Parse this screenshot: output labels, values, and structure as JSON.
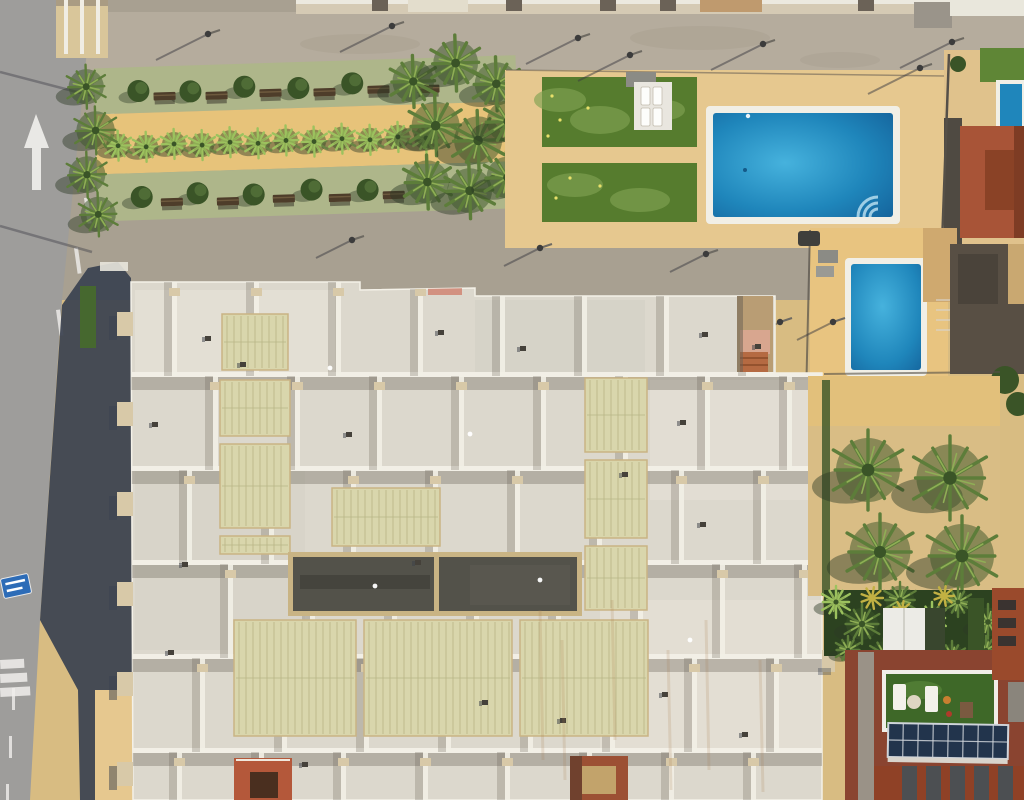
{
  "scene": {
    "description": "Top-down aerial drone photograph of a Mediterranean apartment complex: white terraced roof with skylights and a dark central lightwell, communal swimming pool with lawn and sun loungers, a second smaller pool, palm-lined garden promenade along a grey road with a white arrow marking, palm courtyard, and a neighbouring terracotta building with rooftop terrace and solar panels",
    "view": "orthogonal top-down",
    "lighting": "sunny, shadows cast to lower-left"
  },
  "palette": {
    "road": "#9e9d9b",
    "road_mark": "#f0efec",
    "promenade": "#b5ac9d",
    "walkway": "#a8a091",
    "stain": "#857d6f",
    "sand": "#d8bc82",
    "deck": "#e6c88f",
    "deck_bright": "#e8c480",
    "garden_green": "#aeb68a",
    "garden_orange": "#e7c37a",
    "tree_dark": "#3a5427",
    "tree_mid": "#5d7d3a",
    "tree_light": "#8fae55",
    "palm_bright": "#9cc25e",
    "palm_yellow": "#c2b143",
    "planter": "#d2b584",
    "bench": "#4e3d2a",
    "lawn": "#567c2e",
    "lawn_light": "#7fa251",
    "flower": "#e8e06a",
    "pool_rim": "#f1efe6",
    "pool_light": "#46b2dd",
    "pool_mid": "#1f86bb",
    "pool_deep": "#135e97",
    "pool_step": "#bfe4f2",
    "roof_base": "#dcd8cd",
    "roof_light": "#eae6db",
    "roof_dim": "#d2cfc4",
    "parapet": "#f2efe6",
    "parapet_tan": "#d8c9a8",
    "roof_shadow": "#5f594d",
    "skylight": "#d9d6ac",
    "skylight_rib": "#b9b586",
    "dark_roof": "#53524a",
    "dark_roof_frame": "#c9b484",
    "shadow_navy": "#394150",
    "terracotta": "#a85437",
    "terracotta_dark": "#7e3c24",
    "red_roof": "#8a4430",
    "red_struct": "#b4583a",
    "turf": "#3e6828",
    "solar": "#22344c",
    "solar_line": "#cfd4da",
    "white": "#f3f1ea",
    "fence": "#555048",
    "grey_struct": "#584f44",
    "sign_blue": "#2d6cb7",
    "car": "#3f3f3c",
    "pergola": "#ecebe6",
    "grass": "#5f8636",
    "rust": "#a87c4e",
    "hedge": "#46682f"
  },
  "road": {
    "arrow": "up",
    "lane_dashes": [
      [
        108,
        98
      ],
      [
        95,
        148
      ],
      [
        84,
        198
      ],
      [
        74,
        248
      ],
      [
        56,
        310
      ]
    ],
    "lower_dashes": [
      [
        12,
        688
      ],
      [
        9,
        736
      ],
      [
        6,
        784
      ]
    ],
    "crosswalk_stripes": 3,
    "shadow_lines": [
      [
        100,
        98,
        0,
        72
      ],
      [
        92,
        252,
        0,
        226
      ]
    ]
  },
  "lamps": {
    "top": [
      [
        208,
        34
      ],
      [
        392,
        26
      ],
      [
        578,
        38
      ],
      [
        763,
        44
      ],
      [
        952,
        42
      ],
      [
        630,
        55
      ],
      [
        920,
        68
      ]
    ],
    "path": [
      [
        352,
        240
      ],
      [
        540,
        248
      ],
      [
        706,
        254
      ],
      [
        780,
        322
      ],
      [
        833,
        322
      ]
    ]
  },
  "garden": {
    "palm_row": [
      [
        118,
        140
      ],
      [
        146,
        142
      ],
      [
        174,
        140
      ],
      [
        202,
        142
      ],
      [
        230,
        140
      ],
      [
        258,
        142
      ],
      [
        286,
        140
      ],
      [
        314,
        142
      ],
      [
        342,
        140
      ],
      [
        370,
        142
      ],
      [
        398,
        140
      ],
      [
        426,
        142
      ]
    ],
    "olives_top": [
      [
        140,
        86
      ],
      [
        192,
        88
      ],
      [
        246,
        85
      ],
      [
        300,
        88
      ],
      [
        354,
        85
      ]
    ],
    "olives_bottom": [
      [
        140,
        192
      ],
      [
        196,
        190
      ],
      [
        252,
        193
      ],
      [
        310,
        190
      ],
      [
        366,
        192
      ]
    ],
    "benches_top": [
      [
        166,
        92
      ],
      [
        218,
        93
      ],
      [
        272,
        92
      ],
      [
        326,
        93
      ],
      [
        380,
        92
      ],
      [
        430,
        93
      ]
    ],
    "benches_bottom": [
      [
        170,
        198
      ],
      [
        226,
        199
      ],
      [
        282,
        198
      ],
      [
        338,
        199
      ],
      [
        392,
        198
      ]
    ],
    "left_cluster": [
      [
        88,
        80,
        22
      ],
      [
        96,
        124,
        24
      ],
      [
        86,
        168,
        23
      ],
      [
        96,
        208,
        22
      ]
    ],
    "right_cluster": [
      [
        415,
        85,
        26
      ],
      [
        458,
        68,
        28
      ],
      [
        498,
        90,
        27
      ],
      [
        436,
        130,
        30
      ],
      [
        478,
        146,
        30
      ],
      [
        508,
        128,
        26
      ],
      [
        426,
        186,
        27
      ],
      [
        468,
        196,
        28
      ],
      [
        506,
        184,
        26
      ]
    ]
  },
  "pool_area": {
    "loungers": [
      [
        641,
        87
      ],
      [
        653,
        87
      ],
      [
        641,
        108
      ],
      [
        653,
        108
      ]
    ],
    "flowers": [
      [
        552,
        96
      ],
      [
        560,
        120
      ],
      [
        548,
        136
      ],
      [
        570,
        178
      ],
      [
        556,
        198
      ],
      [
        588,
        108
      ],
      [
        600,
        186
      ]
    ]
  },
  "courtyard_palms": [
    [
      868,
      470,
      40
    ],
    [
      950,
      478,
      42
    ],
    [
      880,
      552,
      38
    ],
    [
      962,
      556,
      40
    ]
  ],
  "veg_blobs": [
    [
      836,
      602,
      16
    ],
    [
      862,
      624,
      20
    ],
    [
      900,
      600,
      18
    ],
    [
      932,
      618,
      16
    ],
    [
      958,
      602,
      15
    ],
    [
      988,
      622,
      18
    ],
    [
      1012,
      604,
      14
    ],
    [
      848,
      650,
      14
    ],
    [
      884,
      654,
      16
    ],
    [
      918,
      650,
      14
    ],
    [
      952,
      656,
      15
    ],
    [
      986,
      650,
      14
    ]
  ],
  "veg_yellow": [
    [
      872,
      598,
      11
    ],
    [
      902,
      610,
      9
    ],
    [
      944,
      596,
      10
    ],
    [
      1016,
      644,
      9
    ]
  ],
  "roof": {
    "row_ys": [
      376,
      470,
      564,
      658,
      752
    ],
    "col_xs": [
      172,
      254,
      336,
      418,
      500,
      582,
      664,
      746
    ],
    "row_offsets": [
      0,
      41,
      15,
      56,
      28,
      5
    ],
    "skylights": [
      [
        222,
        314,
        66,
        56
      ],
      [
        220,
        380,
        70,
        56
      ],
      [
        220,
        444,
        70,
        84
      ],
      [
        220,
        536,
        70,
        18
      ],
      [
        585,
        378,
        62,
        74
      ],
      [
        585,
        460,
        62,
        78
      ],
      [
        585,
        546,
        62,
        64
      ],
      [
        332,
        488,
        108,
        58
      ],
      [
        234,
        620,
        122,
        116
      ],
      [
        364,
        620,
        148,
        116
      ],
      [
        520,
        620,
        128,
        116
      ]
    ],
    "vents": [
      [
        205,
        336
      ],
      [
        438,
        330
      ],
      [
        520,
        346
      ],
      [
        702,
        332
      ],
      [
        755,
        344
      ],
      [
        152,
        422
      ],
      [
        346,
        432
      ],
      [
        622,
        472
      ],
      [
        700,
        522
      ],
      [
        182,
        562
      ],
      [
        482,
        700
      ],
      [
        662,
        692
      ],
      [
        302,
        762
      ],
      [
        560,
        718
      ],
      [
        742,
        732
      ],
      [
        240,
        362
      ],
      [
        680,
        420
      ],
      [
        168,
        650
      ],
      [
        415,
        560
      ]
    ],
    "white_dots": [
      [
        375,
        586
      ],
      [
        540,
        580
      ],
      [
        470,
        434
      ],
      [
        330,
        368
      ],
      [
        690,
        640
      ]
    ],
    "left_tabs": [
      312,
      402,
      492,
      582,
      672,
      762
    ],
    "right_tabs": [
      396,
      482,
      566,
      650
    ],
    "streaks": [
      [
        540,
        610,
        760
      ],
      [
        562,
        640,
        780
      ],
      [
        612,
        600,
        740
      ],
      [
        668,
        650,
        790
      ],
      [
        706,
        620,
        770
      ],
      [
        760,
        660,
        792
      ]
    ]
  },
  "solar": {
    "rows": 2,
    "cols": 8
  },
  "carport_stripes": 5
}
